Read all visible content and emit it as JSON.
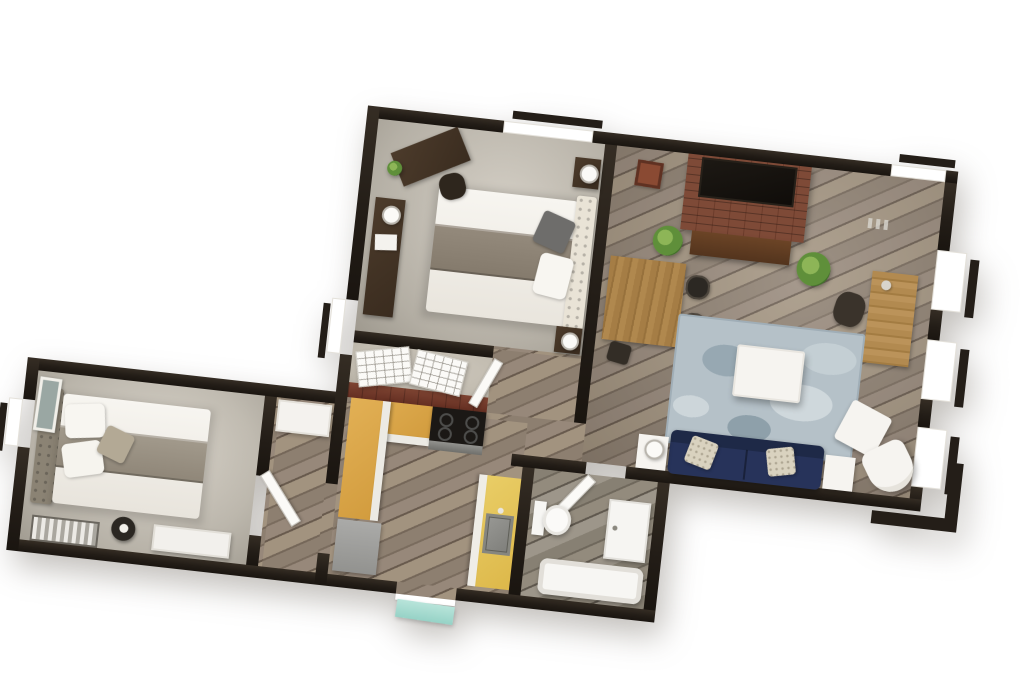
{
  "scene": {
    "description": "3D rendered top-down floor plan of an apartment on a white background, rotated slightly clockwise",
    "background_color": "#ffffff",
    "rotation_deg": 6.4,
    "text_labels": []
  },
  "palette": {
    "wall": "#241e18",
    "wood_floor_mid": "#8d7f70",
    "wood_floor_dark": "#685a4d",
    "wood_floor_light": "#a2937f",
    "carpet_bedroom_top": "#c6c0b4",
    "carpet_bedroom_wing": "#cdc7bc",
    "bathroom_floor": "#878073",
    "counter_yellow": "#ddb84a",
    "counter_orange_yellow": "#d29c3e",
    "brick": "#7e4a37",
    "rug_blue_gray": "#b5c1c8",
    "sofa_navy": "#27335a",
    "plant_green": "#5f8f3a",
    "furniture_dark_wood": "#4c3b2b",
    "furniture_mid_wood": "#a57d45",
    "fixture_white": "#f6f4f0",
    "appliance_gray": "#9a9a98",
    "entry_mat_teal": "#96d2c6"
  },
  "rooms": [
    {
      "name": "bedroom-top",
      "floor": "carpet",
      "furniture": [
        "queen-bed",
        "tufted-headboard",
        "dark-throw-pillow",
        "nightstand-with-lamp-upper",
        "nightstand-with-lamp-lower",
        "corner-desk",
        "desk-chair",
        "desk-plant",
        "dresser",
        "dresser-lamp",
        "closet-shelving-rack-left",
        "closet-shelving-rack-right"
      ]
    },
    {
      "name": "living-room",
      "floor": "hardwood",
      "furniture": [
        "brick-fireplace",
        "wall-tv",
        "media-console",
        "potted-plant-left",
        "potted-plant-right",
        "wall-decor",
        "dining-table",
        "dining-chair-upper",
        "dining-chair-lower",
        "dining-stool",
        "writing-desk",
        "desk-chair",
        "area-rug",
        "coffee-table",
        "navy-sofa",
        "throw-pillow-left",
        "throw-pillow-right",
        "side-table-with-lamp",
        "side-table",
        "ottoman",
        "accent-armchair"
      ]
    },
    {
      "name": "kitchen",
      "floor": "hardwood",
      "furniture": [
        "l-shaped-counter",
        "range-stove",
        "refrigerator",
        "island-counter",
        "kitchen-sink"
      ]
    },
    {
      "name": "bathroom",
      "floor": "wood-tile",
      "furniture": [
        "toilet",
        "laundry-cabinet",
        "bathtub",
        "bathroom-door"
      ]
    },
    {
      "name": "bedroom-wing",
      "floor": "carpet",
      "furniture": [
        "double-bed",
        "tufted-headboard",
        "framed-artwork",
        "round-nightstand",
        "radiator",
        "white-dresser"
      ]
    },
    {
      "name": "hallway-wing",
      "floor": "hardwood",
      "furniture": [
        "wardrobe-cabinet",
        "open-door"
      ]
    }
  ],
  "openings": {
    "window_count": 7,
    "door_count": 5,
    "entry_mat_color": "#96d2c6"
  }
}
